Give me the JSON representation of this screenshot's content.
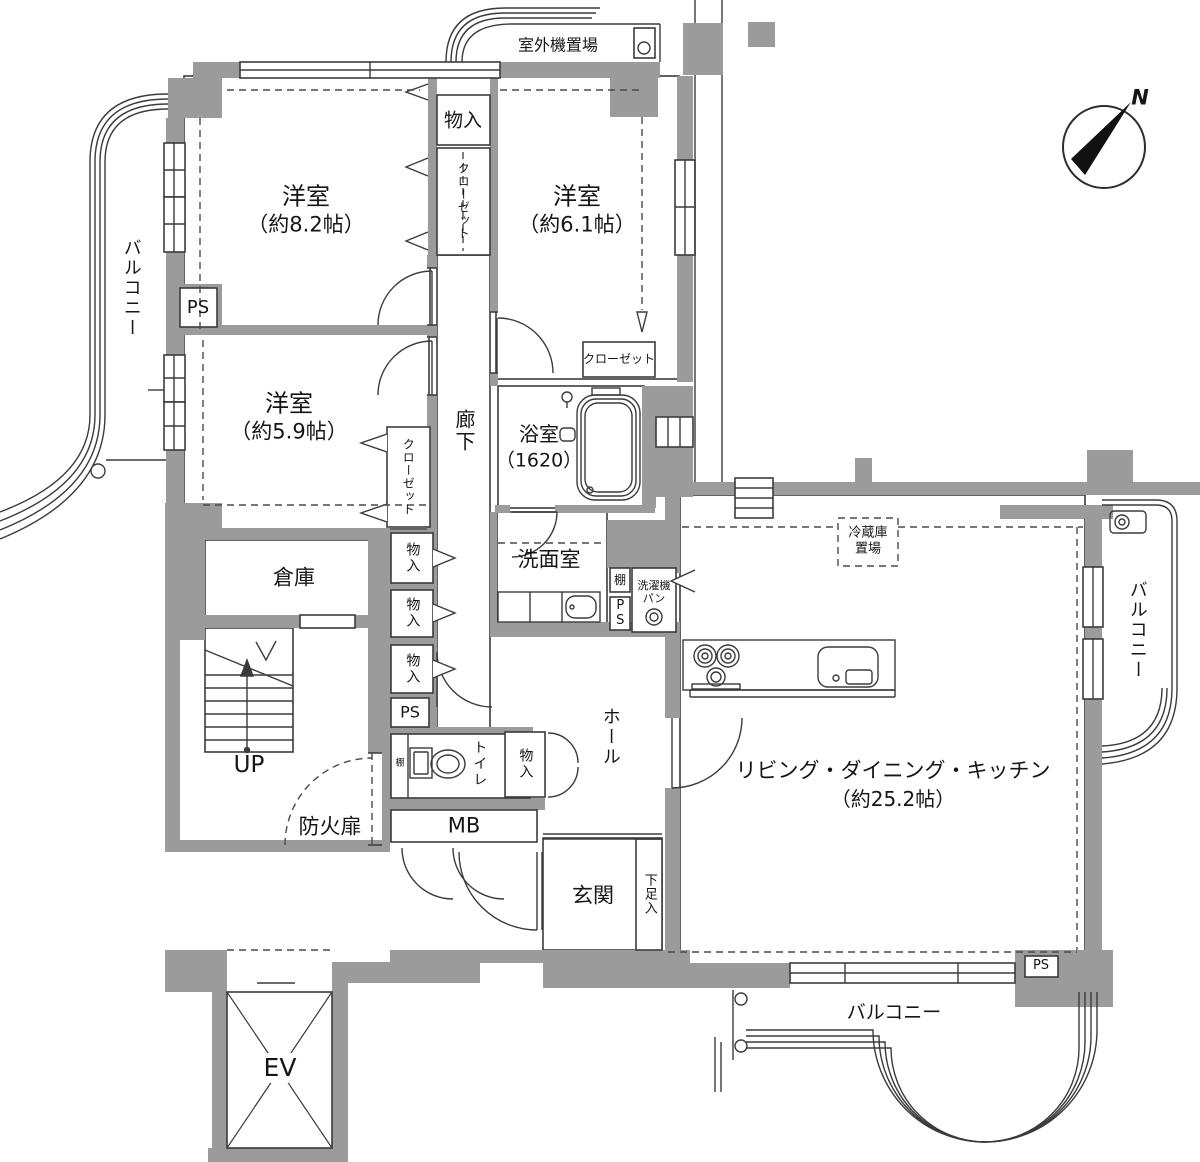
{
  "compass": {
    "north": "N"
  },
  "labels": {
    "outdoor_unit": "室外機置場",
    "bedroom1_name": "洋室",
    "bedroom1_size": "（約8.2帖）",
    "bedroom2_name": "洋室",
    "bedroom2_size": "（約6.1帖）",
    "bedroom3_name": "洋室",
    "bedroom3_size": "（約5.9帖）",
    "ldk_name": "リビング・ダイニング・キッチン",
    "ldk_size": "（約25.2帖）",
    "bath_name": "浴室",
    "bath_size": "（1620）",
    "washroom": "洗面室",
    "toilet": "トイレ",
    "hall": "ホール",
    "corridor": "廊下",
    "entrance": "玄関",
    "storeroom": "倉庫",
    "elevator": "EV",
    "balcony_left": "バルコニー",
    "balcony_right": "バルコニー",
    "balcony_bottom": "バルコニー",
    "closet_top": "クローゼット",
    "closet_b3": "クローゼット",
    "closet_b2": "クローゼット",
    "monoire_top": "物入",
    "monoire_1": "物入",
    "monoire_2": "物入",
    "monoire_3": "物入",
    "monoire_hall": "物入",
    "ps_left": "PS",
    "ps_mid": "PS",
    "ps_wash": "PS",
    "ps_bottom": "PS",
    "mb": "MB",
    "shelf_wash": "棚",
    "shelf_toilet": "棚",
    "washer_pan": "洗濯機パン",
    "fridge_space": "冷蔵庫置場",
    "fire_door": "防火扉",
    "up": "UP",
    "shoe_box": "下足入"
  }
}
